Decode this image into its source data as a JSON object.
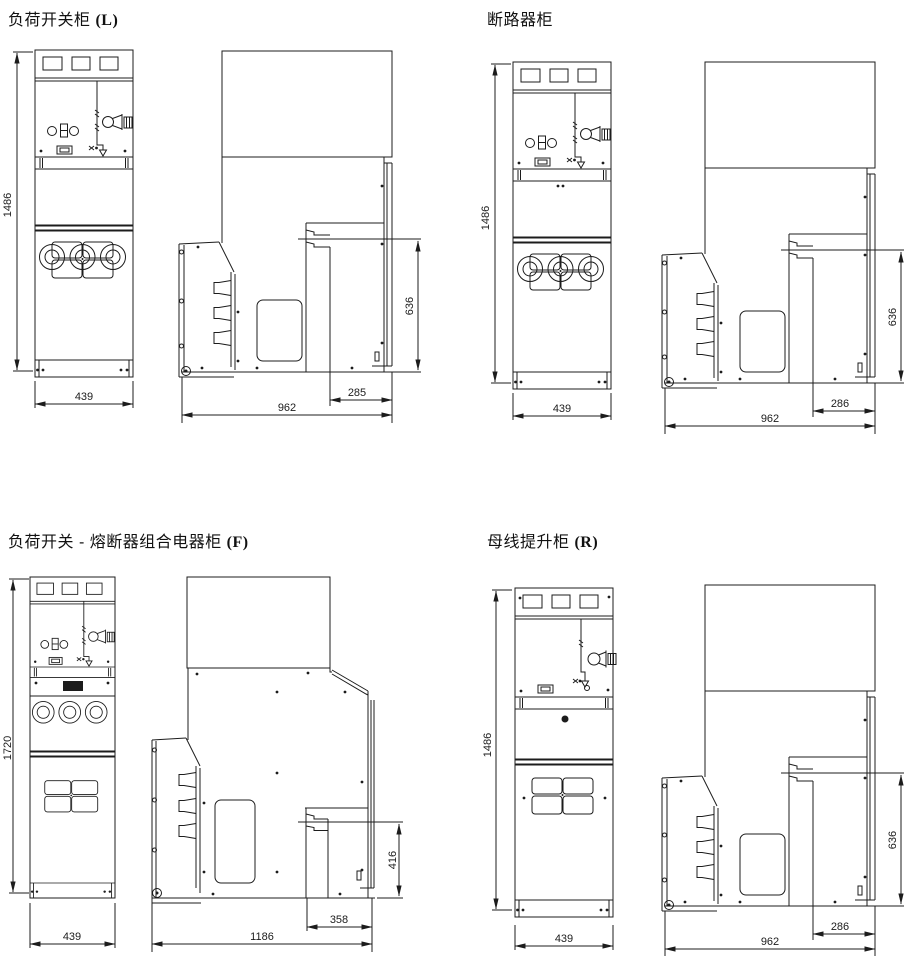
{
  "sheet": {
    "background": "#ffffff",
    "line_color": "#1c1c1c"
  },
  "panels": {
    "load_switch": {
      "title_cn": "负荷开关柜 ",
      "title_code": "(L)",
      "dims": {
        "height": "1486",
        "width": "439",
        "side_depth": "962",
        "side_offset": "285",
        "side_height": "636"
      }
    },
    "breaker": {
      "title_cn": "断路器柜",
      "title_code": "",
      "dims": {
        "height": "1486",
        "width": "439",
        "side_depth": "962",
        "side_offset": "286",
        "side_height": "636"
      }
    },
    "fuse_combo": {
      "title_cn": "负荷开关 - 熔断器组合电器柜 ",
      "title_code": "(F)",
      "dims": {
        "height": "1720",
        "width": "439",
        "side_depth": "1186",
        "side_offset": "358",
        "side_height": "416"
      }
    },
    "bus_riser": {
      "title_cn": "母线提升柜 ",
      "title_code": "(R)",
      "dims": {
        "height": "1486",
        "width": "439",
        "side_depth": "962",
        "side_offset": "286",
        "side_height": "636"
      }
    }
  }
}
